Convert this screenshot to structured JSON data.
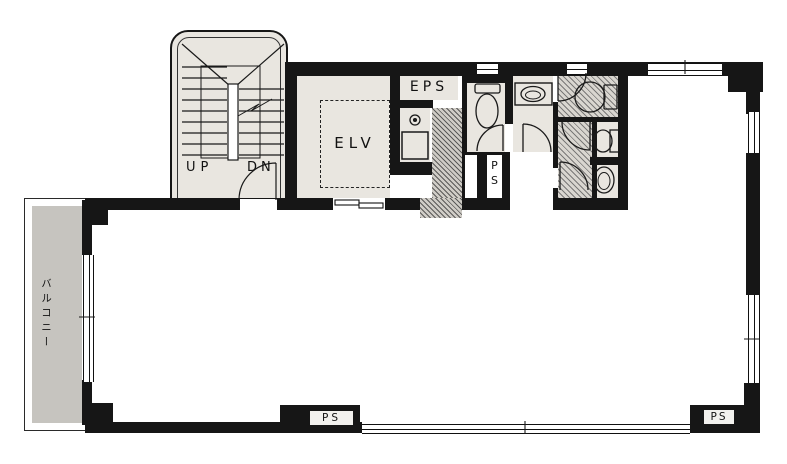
{
  "document_type": "architectural-floor-plan",
  "colors": {
    "paper": "#ffffff",
    "wall": "#161616",
    "line": "#1a1a1a",
    "room_fill": "#e9e6e0",
    "hatch_base": "#d9d6d0",
    "shaft_base": "#cfccc6",
    "balcony_fill": "#c6c4bf"
  },
  "labels": {
    "stairwell": {
      "up": "UP",
      "down": "DN"
    },
    "elevator": "ELV",
    "eps": "EPS",
    "pipe_shaft_top": "PS",
    "pipe_shaft_bottom_center": "PS",
    "pipe_shaft_bottom_right": "PS",
    "balcony": "バルコニー"
  },
  "legend": {
    "fixture_icons": [
      "staircase-with-break-line",
      "elevator-car-dashed",
      "elevator-sliding-door",
      "door-swing-arc",
      "toilet-western",
      "toilet-western-large",
      "toilet-small",
      "urinal",
      "wash-basin-counter",
      "kitchen-sink-square",
      "faucet-symbol",
      "double-line-window",
      "hatched-duct-space"
    ]
  }
}
